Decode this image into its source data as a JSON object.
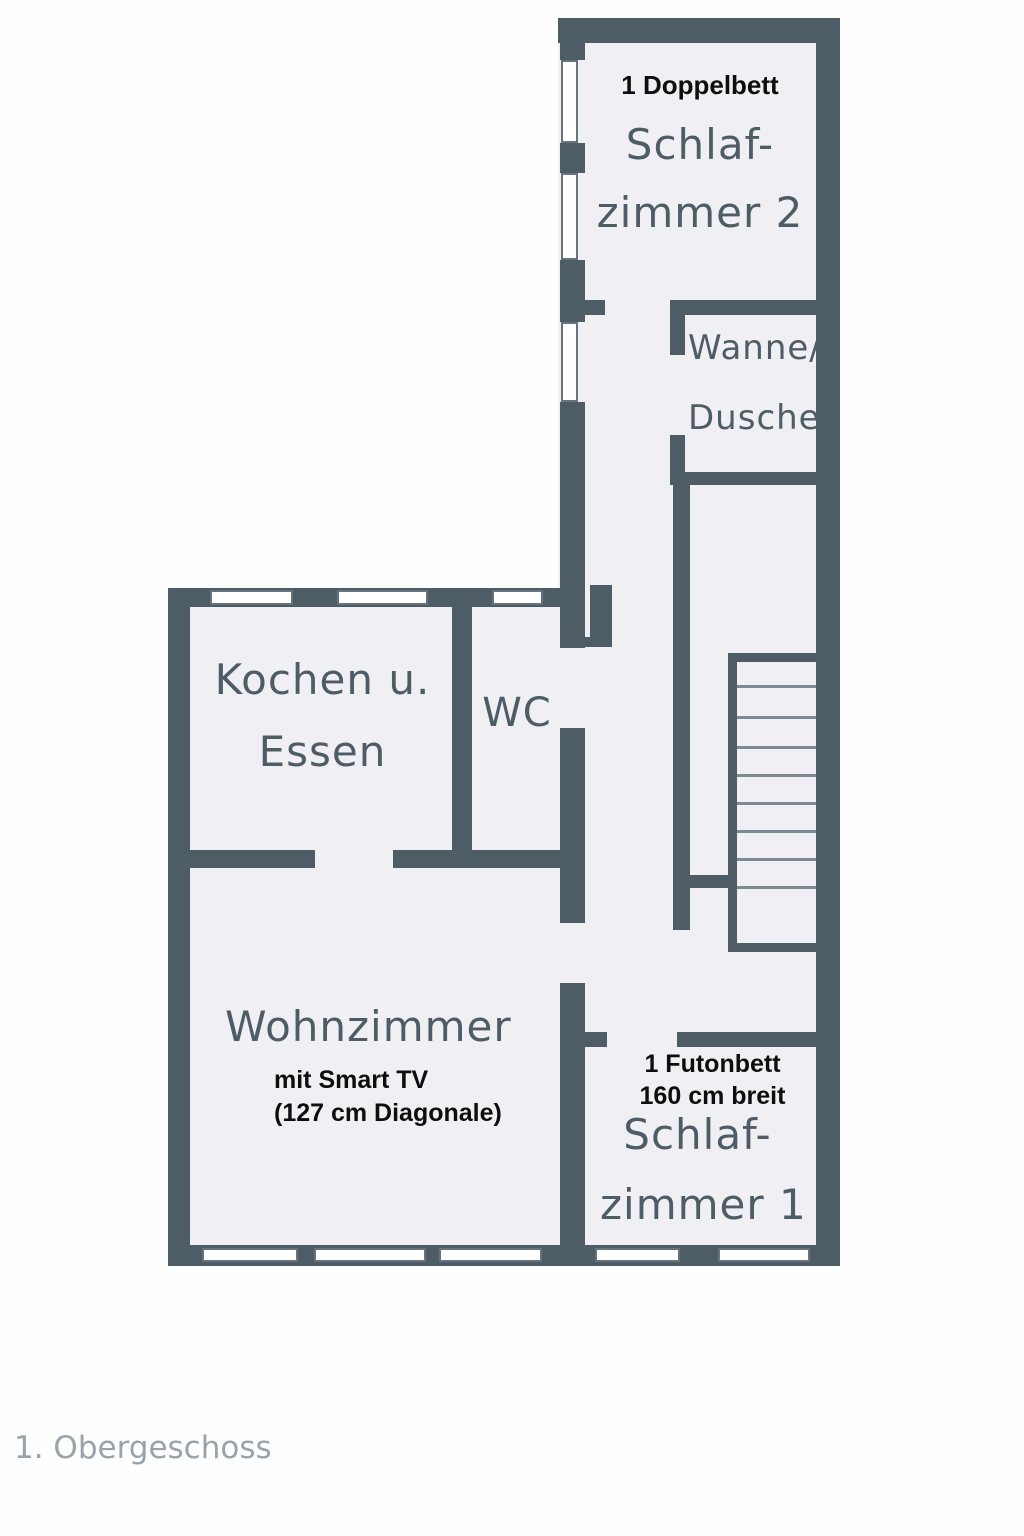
{
  "floor_label": "1. Obergeschoss",
  "colors": {
    "wall": "#4e5c66",
    "room_fill": "#f0f0f4",
    "page_bg": "#fefefe",
    "note_text": "#0e0e0e",
    "room_text": "#4e5c66",
    "floor_label_text": "#9aa2aa",
    "step_line": "#7d8a93",
    "window_outline": "#66737e"
  },
  "rooms": {
    "schlafzimmer2": {
      "note": "1 Doppelbett",
      "name_line1": "Schlaf-",
      "name_line2": "zimmer 2"
    },
    "bad": {
      "name_line1": "Wanne/",
      "name_line2": "Dusche"
    },
    "kueche": {
      "name_line1": "Kochen u.",
      "name_line2": "Essen"
    },
    "wc": {
      "name": "WC"
    },
    "wohnzimmer": {
      "name": "Wohnzimmer",
      "note_line1": "mit Smart TV",
      "note_line2": "(127 cm Diagonale)"
    },
    "schlafzimmer1": {
      "note_line1": "1 Futonbett",
      "note_line2": "160 cm breit",
      "name_line1": "Schlaf-",
      "name_line2": "zimmer 1"
    }
  }
}
